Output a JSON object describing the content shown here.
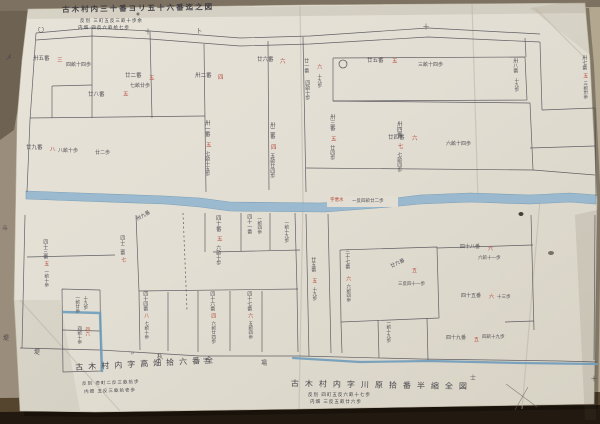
{
  "title": {
    "text": "古木村内三十番ヨリ五十六番迄之図",
    "sub1": "反別 三町五反三畝十歩余",
    "sub2": "内畑 四反六畝拾七歩"
  },
  "annotations": {
    "bottom_left_main": "古木村内字高畑拾六番全",
    "bottom_left_sub1": "反別 壱町二反三畝拾歩",
    "bottom_left_sub2": "内畑 五反三畝拾壱歩",
    "bottom_right_main": "古木村内字川原拾番半縮全図",
    "bottom_right_sub1": "反別 四町五反六畝十七歩",
    "bottom_right_sub2": "内畑 三反五畝廿六歩"
  },
  "river_label": {
    "red": "字悪水",
    "black": "一反四畝廿二歩"
  },
  "colors": {
    "ink": "#3f3e47",
    "red_ink": "#b23c2c",
    "boundary": "#4b4a52",
    "river_fill": "#8fb4cf",
    "river_edge": "#6a95b3",
    "blue_line": "#6f9cbb",
    "paper": "#e2ded3"
  },
  "labels": [
    {
      "t": "〇",
      "x": 38,
      "y": 28,
      "s": 6
    },
    {
      "t": "十",
      "x": 145,
      "y": 30,
      "s": 6
    },
    {
      "t": "卜",
      "x": 196,
      "y": 29,
      "s": 6
    },
    {
      "t": "十",
      "x": 423,
      "y": 25,
      "s": 6
    },
    {
      "t": "乄",
      "x": 6,
      "y": 55,
      "s": 6
    },
    {
      "t": "斗",
      "x": 2,
      "y": 226,
      "s": 6
    },
    {
      "t": "堤",
      "x": 3,
      "y": 336,
      "s": 6
    },
    {
      "t": "卅五番",
      "x": 33,
      "y": 57,
      "s": 5.5
    },
    {
      "t": "三",
      "x": 57,
      "y": 59,
      "s": 5.5,
      "c": "red"
    },
    {
      "t": "四畝十四歩",
      "x": 66,
      "y": 63,
      "s": 5
    },
    {
      "t": "廿二番",
      "x": 125,
      "y": 74,
      "s": 5.5
    },
    {
      "t": "五",
      "x": 149,
      "y": 77,
      "s": 5.5,
      "c": "red"
    },
    {
      "t": "七畝廿歩",
      "x": 130,
      "y": 84,
      "s": 5
    },
    {
      "t": "廿八番",
      "x": 88,
      "y": 93,
      "s": 5.5
    },
    {
      "t": "五",
      "x": 123,
      "y": 93,
      "s": 5.5,
      "c": "red"
    },
    {
      "t": "卅二番",
      "x": 195,
      "y": 74,
      "s": 5.5
    },
    {
      "t": "四",
      "x": 218,
      "y": 76,
      "s": 5.5,
      "c": "red"
    },
    {
      "t": "廿六番",
      "x": 257,
      "y": 58,
      "s": 5.5
    },
    {
      "t": "六",
      "x": 280,
      "y": 60,
      "s": 5.5,
      "c": "red"
    },
    {
      "t": "廿九番",
      "x": 26,
      "y": 146,
      "s": 5.5
    },
    {
      "t": "八",
      "x": 50,
      "y": 148,
      "s": 5.5,
      "c": "red"
    },
    {
      "t": "八畝十歩",
      "x": 58,
      "y": 149,
      "s": 5
    },
    {
      "t": "廿二歩",
      "x": 95,
      "y": 151,
      "s": 5
    },
    {
      "t": "廿一番",
      "x": 303,
      "y": 58,
      "s": 5,
      "o": "v"
    },
    {
      "t": "四畝十歩",
      "x": 304,
      "y": 80,
      "s": 5,
      "o": "v"
    },
    {
      "t": "六",
      "x": 316,
      "y": 64,
      "s": 5,
      "c": "red",
      "o": "v"
    },
    {
      "t": "十九歩",
      "x": 316,
      "y": 74,
      "s": 4.5,
      "o": "v"
    },
    {
      "t": "廿五番",
      "x": 367,
      "y": 59,
      "s": 5.5
    },
    {
      "t": "五",
      "x": 392,
      "y": 60,
      "s": 5.5,
      "c": "red"
    },
    {
      "t": "三畝十四歩",
      "x": 418,
      "y": 63,
      "s": 5
    },
    {
      "t": "廿四番",
      "x": 388,
      "y": 136,
      "s": 5.5
    },
    {
      "t": "六",
      "x": 412,
      "y": 137,
      "s": 5.5,
      "c": "red"
    },
    {
      "t": "六畝十四歩",
      "x": 446,
      "y": 142,
      "s": 5
    },
    {
      "t": "卅八番",
      "x": 512,
      "y": 58,
      "s": 5,
      "o": "v"
    },
    {
      "t": "十九歩",
      "x": 513,
      "y": 78,
      "s": 4.5,
      "o": "v"
    },
    {
      "t": "卅七番",
      "x": 581,
      "y": 55,
      "s": 5,
      "o": "v"
    },
    {
      "t": "五",
      "x": 582,
      "y": 73,
      "s": 5,
      "c": "red",
      "o": "v"
    },
    {
      "t": "三畝卅歩",
      "x": 582,
      "y": 81,
      "s": 4.5,
      "o": "v"
    },
    {
      "t": "卅一番",
      "x": 203,
      "y": 120,
      "s": 5.5,
      "o": "v"
    },
    {
      "t": "五",
      "x": 204,
      "y": 142,
      "s": 5.5,
      "c": "red",
      "o": "v"
    },
    {
      "t": "七畝十五歩",
      "x": 204,
      "y": 151,
      "s": 5,
      "o": "v"
    },
    {
      "t": "卅二番",
      "x": 268,
      "y": 122,
      "s": 5.5,
      "o": "v"
    },
    {
      "t": "四",
      "x": 269,
      "y": 144,
      "s": 5.5,
      "c": "red",
      "o": "v"
    },
    {
      "t": "五畝廿四歩",
      "x": 269,
      "y": 153,
      "s": 5,
      "o": "v"
    },
    {
      "t": "卅三番",
      "x": 328,
      "y": 114,
      "s": 5.5,
      "o": "v"
    },
    {
      "t": "五",
      "x": 329,
      "y": 136,
      "s": 5.5,
      "c": "red",
      "o": "v"
    },
    {
      "t": "廿四歩",
      "x": 329,
      "y": 145,
      "s": 5,
      "o": "v"
    },
    {
      "t": "卅四番",
      "x": 395,
      "y": 121,
      "s": 5.5,
      "o": "v"
    },
    {
      "t": "七",
      "x": 396,
      "y": 143,
      "s": 5.5,
      "c": "red",
      "o": "v"
    },
    {
      "t": "七畝四歩",
      "x": 396,
      "y": 152,
      "s": 5,
      "o": "v"
    },
    {
      "t": "卅九番",
      "x": 136,
      "y": 218,
      "s": 5,
      "r": -30
    },
    {
      "t": "四十番",
      "x": 214,
      "y": 215,
      "s": 5.5,
      "o": "v"
    },
    {
      "t": "五",
      "x": 215,
      "y": 236,
      "s": 5.5,
      "c": "red",
      "o": "v"
    },
    {
      "t": "六畝十歩",
      "x": 215,
      "y": 245,
      "s": 5,
      "o": "v"
    },
    {
      "t": "四十一番",
      "x": 246,
      "y": 214,
      "s": 5,
      "o": "v"
    },
    {
      "t": "一畝四歩",
      "x": 256,
      "y": 216,
      "s": 4.5,
      "o": "v"
    },
    {
      "t": "一畝十九歩",
      "x": 283,
      "y": 220,
      "s": 4.5,
      "o": "v"
    },
    {
      "t": "四十二番",
      "x": 119,
      "y": 235,
      "s": 5,
      "o": "v"
    },
    {
      "t": "七",
      "x": 120,
      "y": 257,
      "s": 5,
      "c": "red",
      "o": "v"
    },
    {
      "t": "四十三番",
      "x": 42,
      "y": 239,
      "s": 5,
      "o": "v"
    },
    {
      "t": "五",
      "x": 43,
      "y": 261,
      "s": 5,
      "c": "red",
      "o": "v"
    },
    {
      "t": "一畝十歩",
      "x": 43,
      "y": 269,
      "s": 4.5,
      "o": "v"
    },
    {
      "t": "四十四番",
      "x": 142,
      "y": 291,
      "s": 5,
      "o": "v"
    },
    {
      "t": "八",
      "x": 143,
      "y": 313,
      "s": 5,
      "c": "red",
      "o": "v"
    },
    {
      "t": "七畝十歩",
      "x": 143,
      "y": 321,
      "s": 4.5,
      "o": "v"
    },
    {
      "t": "四十六番",
      "x": 209,
      "y": 291,
      "s": 5,
      "o": "v"
    },
    {
      "t": "四",
      "x": 210,
      "y": 313,
      "s": 5,
      "c": "red",
      "o": "v"
    },
    {
      "t": "六畝廿四歩",
      "x": 210,
      "y": 321,
      "s": 4.5,
      "o": "v"
    },
    {
      "t": "四十七番",
      "x": 246,
      "y": 291,
      "s": 5,
      "o": "v"
    },
    {
      "t": "六",
      "x": 247,
      "y": 313,
      "s": 5,
      "c": "red",
      "o": "v"
    },
    {
      "t": "五畝四歩",
      "x": 247,
      "y": 321,
      "s": 4.5,
      "o": "v"
    },
    {
      "t": "一畝廿歩",
      "x": 74,
      "y": 295,
      "s": 4.5,
      "o": "v"
    },
    {
      "t": "十九歩",
      "x": 82,
      "y": 296,
      "s": 4.5,
      "o": "v"
    },
    {
      "t": "四六",
      "x": 84,
      "y": 327,
      "s": 4.5,
      "c": "red",
      "o": "v"
    },
    {
      "t": "四畝十歩",
      "x": 76,
      "y": 326,
      "s": 4.5,
      "o": "v"
    },
    {
      "t": "廿五番",
      "x": 310,
      "y": 257,
      "s": 5,
      "o": "v"
    },
    {
      "t": "五",
      "x": 311,
      "y": 278,
      "s": 5,
      "c": "red",
      "o": "v"
    },
    {
      "t": "十九歩",
      "x": 311,
      "y": 287,
      "s": 4.5,
      "o": "v"
    },
    {
      "t": "三十七番",
      "x": 344,
      "y": 249,
      "s": 5,
      "o": "v"
    },
    {
      "t": "六",
      "x": 345,
      "y": 276,
      "s": 5,
      "c": "red",
      "o": "v"
    },
    {
      "t": "六畝四歩",
      "x": 345,
      "y": 284,
      "s": 4.5,
      "o": "v"
    },
    {
      "t": "廿六番",
      "x": 390,
      "y": 265,
      "s": 5,
      "r": -25
    },
    {
      "t": "五",
      "x": 412,
      "y": 269,
      "s": 5,
      "c": "red"
    },
    {
      "t": "三反四十一歩",
      "x": 398,
      "y": 283,
      "s": 4.5
    },
    {
      "t": "四十八番",
      "x": 460,
      "y": 245,
      "s": 5
    },
    {
      "t": "六",
      "x": 488,
      "y": 247,
      "s": 5,
      "c": "red"
    },
    {
      "t": "六畝十一歩",
      "x": 478,
      "y": 257,
      "s": 4.5
    },
    {
      "t": "四十五番",
      "x": 461,
      "y": 294,
      "s": 5
    },
    {
      "t": "六",
      "x": 489,
      "y": 295,
      "s": 5,
      "c": "red"
    },
    {
      "t": "十三歩",
      "x": 497,
      "y": 296,
      "s": 4.5
    },
    {
      "t": "一畝十九歩",
      "x": 385,
      "y": 320,
      "s": 4.5,
      "o": "v"
    },
    {
      "t": "四十九番",
      "x": 446,
      "y": 336,
      "s": 5
    },
    {
      "t": "五",
      "x": 474,
      "y": 338,
      "s": 5,
      "c": "red"
    },
    {
      "t": "四畝十九歩",
      "x": 482,
      "y": 336,
      "s": 4.5
    },
    {
      "t": "〃",
      "x": 130,
      "y": 352,
      "s": 5
    },
    {
      "t": "杁",
      "x": 157,
      "y": 355,
      "s": 6
    },
    {
      "t": "字",
      "x": 203,
      "y": 359,
      "s": 6
    },
    {
      "t": "場",
      "x": 261,
      "y": 361,
      "s": 6
    },
    {
      "t": "士",
      "x": 470,
      "y": 376,
      "s": 6
    },
    {
      "t": "十",
      "x": 591,
      "y": 377,
      "s": 6
    },
    {
      "t": "堤",
      "x": 34,
      "y": 350,
      "s": 6
    }
  ],
  "geometry": {
    "backing": [
      {
        "pts": "0,0 600,0 600,424 0,424",
        "fill": "#9a8d7b"
      },
      {
        "pts": "585,0 600,0 600,424 588,424",
        "fill": "#b3a78f"
      },
      {
        "pts": "0,0 32,0 26,60 14,130 0,140",
        "fill": "#6e6253"
      },
      {
        "pts": "0,0 600,0 600,7 0,11",
        "fill": "#7d7162"
      },
      {
        "pts": "0,398 600,392 600,424 0,424",
        "fill": "#55452f"
      },
      {
        "pts": "0,412 600,405 600,424 0,424",
        "fill": "#221a10"
      }
    ],
    "paper": "28,9 300,5 585,3 590,60 597,200 594,404 300,409 95,412 20,411 14,300 17,120 22,60",
    "shade": [
      {
        "pts": "28,9 585,3 585,13 28,19",
        "fill": "rgba(100,88,64,0.12)"
      },
      {
        "pts": "575,215 597,210 596,420 585,420",
        "fill": "rgba(95,85,62,0.12)"
      },
      {
        "pts": "14,300 60,300 80,411 20,411",
        "fill": "rgba(95,85,62,0.08)"
      },
      {
        "pts": "530,8 590,55 590,3 560,3",
        "fill": "rgba(100,88,64,0.08)"
      }
    ],
    "creases": [
      [
        [
          300,
          6
        ],
        [
          303,
          200
        ],
        [
          299,
          409
        ]
      ],
      [
        [
          472,
          4
        ],
        [
          478,
          200
        ]
      ],
      [
        [
          535,
          8
        ],
        [
          585,
          58
        ]
      ],
      [
        [
          20,
          300
        ],
        [
          120,
          411
        ]
      ],
      [
        [
          540,
          200
        ],
        [
          522,
          409
        ]
      ]
    ],
    "river": "26,191 80,193 165,196 200,198 230,202 320,203 388,199 420,195 470,193 530,195 570,193 596,195 596,204 570,202 530,204 470,202 420,204 390,207 325,212 230,211 200,207 165,204 80,201 26,199",
    "river_gap": [
      327,
      196,
      71,
      11
    ],
    "boundaries": [
      [
        [
          36,
          33
        ],
        [
          92,
          28
        ],
        [
          150,
          31
        ],
        [
          240,
          38
        ],
        [
          310,
          36
        ],
        [
          428,
          28
        ],
        [
          540,
          34
        ]
      ],
      [
        [
          36,
          40
        ],
        [
          92,
          36
        ],
        [
          150,
          39
        ],
        [
          240,
          46
        ],
        [
          310,
          44
        ],
        [
          428,
          37
        ],
        [
          540,
          42
        ]
      ],
      [
        [
          36,
          33
        ],
        [
          30,
          120
        ],
        [
          27,
          192
        ]
      ],
      [
        [
          25,
          215
        ],
        [
          22,
          348
        ]
      ],
      [
        [
          52,
          86
        ],
        [
          52,
          118
        ]
      ],
      [
        [
          52,
          86
        ],
        [
          92,
          85
        ]
      ],
      [
        [
          92,
          29
        ],
        [
          92,
          118
        ]
      ],
      [
        [
          150,
          32
        ],
        [
          152,
          118
        ]
      ],
      [
        [
          30,
          118
        ],
        [
          205,
          116
        ]
      ],
      [
        [
          204,
          44
        ],
        [
          205,
          120
        ],
        [
          206,
          192
        ]
      ],
      [
        [
          268,
          41
        ],
        [
          269,
          190
        ]
      ],
      [
        [
          303,
          37
        ],
        [
          306,
          192
        ]
      ],
      [
        [
          333,
          58
        ],
        [
          525,
          57
        ],
        [
          527,
          100
        ],
        [
          333,
          101
        ],
        [
          333,
          58
        ]
      ],
      [
        [
          525,
          38
        ],
        [
          526,
          57
        ]
      ],
      [
        [
          333,
          101
        ],
        [
          530,
          103
        ],
        [
          533,
          170
        ],
        [
          306,
          168
        ]
      ],
      [
        [
          533,
          170
        ],
        [
          595,
          175
        ]
      ],
      [
        [
          540,
          42
        ],
        [
          542,
          110
        ]
      ],
      [
        [
          542,
          110
        ],
        [
          595,
          108
        ]
      ],
      [
        [
          595,
          108
        ],
        [
          596,
          196
        ]
      ],
      [
        [
          530,
          148
        ],
        [
          595,
          146
        ]
      ],
      [
        [
          306,
          214
        ],
        [
          309,
          356
        ]
      ],
      [
        [
          328,
          214
        ],
        [
          331,
          353
        ]
      ],
      [
        [
          136,
          215
        ],
        [
          139,
          292
        ],
        [
          140,
          350
        ]
      ],
      [
        [
          27,
          257
        ],
        [
          115,
          255
        ]
      ],
      [
        [
          213,
          252
        ],
        [
          300,
          250
        ]
      ],
      [
        [
          205,
          213
        ],
        [
          205,
          252
        ]
      ],
      [
        [
          241,
          213
        ],
        [
          241,
          251
        ]
      ],
      [
        [
          270,
          213
        ],
        [
          270,
          250
        ]
      ],
      [
        [
          295,
          213
        ],
        [
          297,
          290
        ],
        [
          298,
          352
        ]
      ],
      [
        [
          139,
          291
        ],
        [
          298,
          289
        ]
      ],
      [
        [
          168,
          292
        ],
        [
          168,
          351
        ]
      ],
      [
        [
          198,
          291
        ],
        [
          198,
          352
        ]
      ],
      [
        [
          230,
          291
        ],
        [
          230,
          351
        ]
      ],
      [
        [
          262,
          291
        ],
        [
          262,
          352
        ]
      ],
      [
        [
          62,
          289
        ],
        [
          100,
          290
        ],
        [
          101,
          371
        ],
        [
          63,
          372
        ],
        [
          62,
          289
        ]
      ],
      [
        [
          62,
          330
        ],
        [
          100,
          331
        ]
      ],
      [
        [
          20,
          348
        ],
        [
          100,
          350
        ],
        [
          200,
          356
        ],
        [
          300,
          356
        ],
        [
          420,
          359
        ],
        [
          560,
          361
        ],
        [
          597,
          362
        ]
      ],
      [
        [
          340,
          250
        ],
        [
          437,
          247
        ],
        [
          439,
          318
        ],
        [
          341,
          322
        ],
        [
          340,
          250
        ]
      ],
      [
        [
          341,
          322
        ],
        [
          342,
          353
        ]
      ],
      [
        [
          378,
          320
        ],
        [
          379,
          358
        ]
      ],
      [
        [
          427,
          318
        ],
        [
          428,
          360
        ]
      ],
      [
        [
          437,
          248
        ],
        [
          533,
          245
        ]
      ],
      [
        [
          531,
          215
        ],
        [
          534,
          330
        ]
      ],
      [
        [
          505,
          322
        ],
        [
          534,
          321
        ]
      ],
      [
        [
          595,
          215
        ],
        [
          594,
          360
        ]
      ]
    ],
    "dashed": [
      [
        [
          183,
          213
        ],
        [
          187,
          310
        ]
      ]
    ],
    "strays": [
      [
        [
          506,
          384
        ],
        [
          537,
          407
        ]
      ],
      [
        [
          528,
          387
        ],
        [
          515,
          410
        ]
      ]
    ],
    "blue_lines": [
      {
        "pts": "293,358 360,362 430,361 520,363 597,364",
        "w": 2.2
      },
      {
        "pts": "63,312 100,313 102,371",
        "w": 2.5
      }
    ],
    "marks": [
      {
        "type": "circle",
        "x": 343,
        "y": 64,
        "r": 4
      }
    ],
    "spots": [
      {
        "x": 521,
        "y": 214,
        "rx": 2.5,
        "ry": 2,
        "fill": "rgba(40,36,30,0.85)"
      },
      {
        "x": 551,
        "y": 253,
        "rx": 3,
        "ry": 2,
        "fill": "rgba(74,69,64,0.7)"
      },
      {
        "x": 138,
        "y": 14,
        "rx": 1.5,
        "ry": 1.5,
        "fill": "rgba(60,56,50,0.6)"
      }
    ]
  }
}
